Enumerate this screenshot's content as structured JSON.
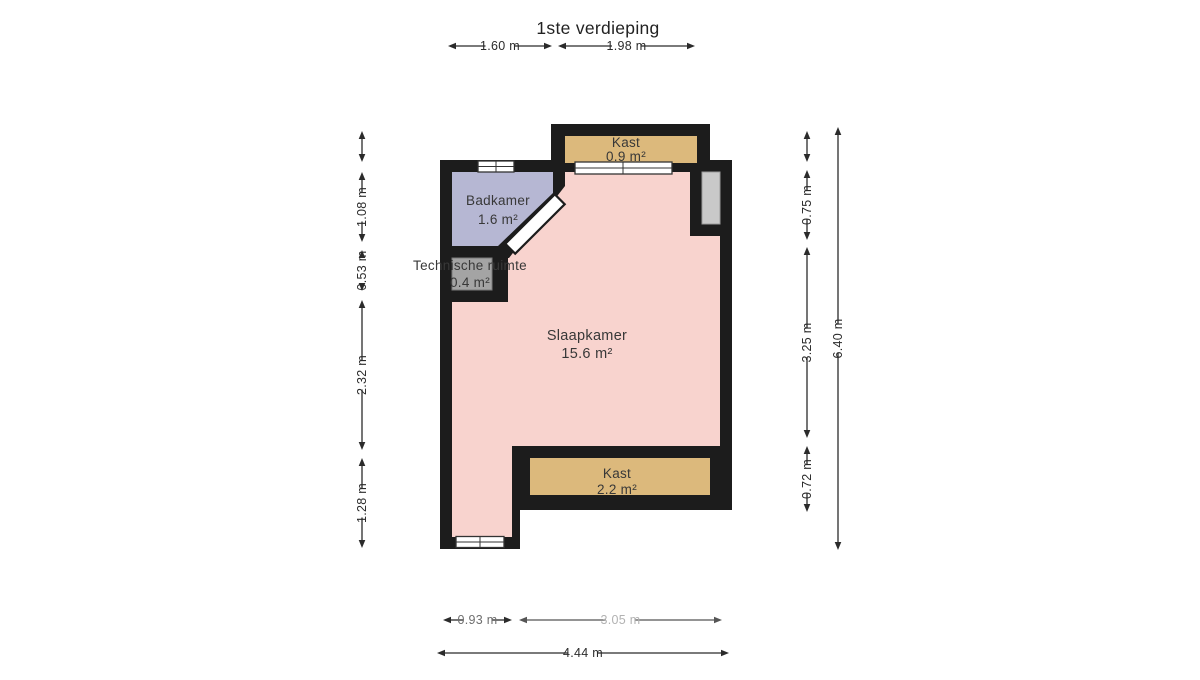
{
  "title": "1ste verdieping",
  "rooms": [
    {
      "id": "kast-top",
      "name": "Kast",
      "area": "0.9 m²"
    },
    {
      "id": "badkamer",
      "name": "Badkamer",
      "area": "1.6 m²"
    },
    {
      "id": "technische-ruimte",
      "name": "Technische ruimte",
      "area": "0.4 m²"
    },
    {
      "id": "slaapkamer",
      "name": "Slaapkamer",
      "area": "15.6 m²"
    },
    {
      "id": "kast-bottom",
      "name": "Kast",
      "area": "2.2 m²"
    }
  ],
  "colors": {
    "wall": "#1c1c1c",
    "slaapkamer": "#f8d3ce",
    "badkamer": "#b6b7d3",
    "kast": "#dcb97c",
    "technische_ruimte": "#a4a4a4",
    "niche": "#c9c9c9",
    "window": "#ffffff",
    "dim_line": "#2b2b2b",
    "room_text": "#383838",
    "title_text": "#222222"
  },
  "dimensions": {
    "top": {
      "axis": "x",
      "line_pos": 46,
      "segments": [
        {
          "from": 448,
          "to": 552,
          "label": "1.60 m"
        },
        {
          "from": 558,
          "to": 695,
          "label": "1.98 m"
        }
      ]
    },
    "left": {
      "axis": "y",
      "line_pos": 362,
      "segments": [
        {
          "from": 131,
          "to": 162,
          "label": ""
        },
        {
          "from": 172,
          "to": 242,
          "label": "1.08 m"
        },
        {
          "from": 250,
          "to": 291,
          "label": "0.53 m"
        },
        {
          "from": 300,
          "to": 450,
          "label": "2.32 m"
        },
        {
          "from": 458,
          "to": 548,
          "label": "1.28 m"
        }
      ]
    },
    "right_inner": {
      "axis": "y",
      "line_pos": 807,
      "segments": [
        {
          "from": 131,
          "to": 162,
          "label": ""
        },
        {
          "from": 170,
          "to": 240,
          "label": "0.75 m"
        },
        {
          "from": 247,
          "to": 438,
          "label": "3.25 m"
        },
        {
          "from": 446,
          "to": 512,
          "label": "0.72 m"
        }
      ]
    },
    "right_outer": {
      "axis": "y",
      "line_pos": 838,
      "segments": [
        {
          "from": 127,
          "to": 550,
          "label": "6.40 m"
        }
      ]
    },
    "bottom_inner": {
      "axis": "x",
      "line_pos": 620,
      "segments": [
        {
          "from": 443,
          "to": 512,
          "label": "0.93 m",
          "label_color": "#6e6e6e"
        },
        {
          "from": 519,
          "to": 722,
          "label": "3.05 m",
          "label_color": "#b2b2b2",
          "color": "#555555"
        }
      ]
    },
    "bottom_outer": {
      "axis": "x",
      "line_pos": 653,
      "segments": [
        {
          "from": 437,
          "to": 729,
          "label": "4.44 m"
        }
      ]
    }
  }
}
